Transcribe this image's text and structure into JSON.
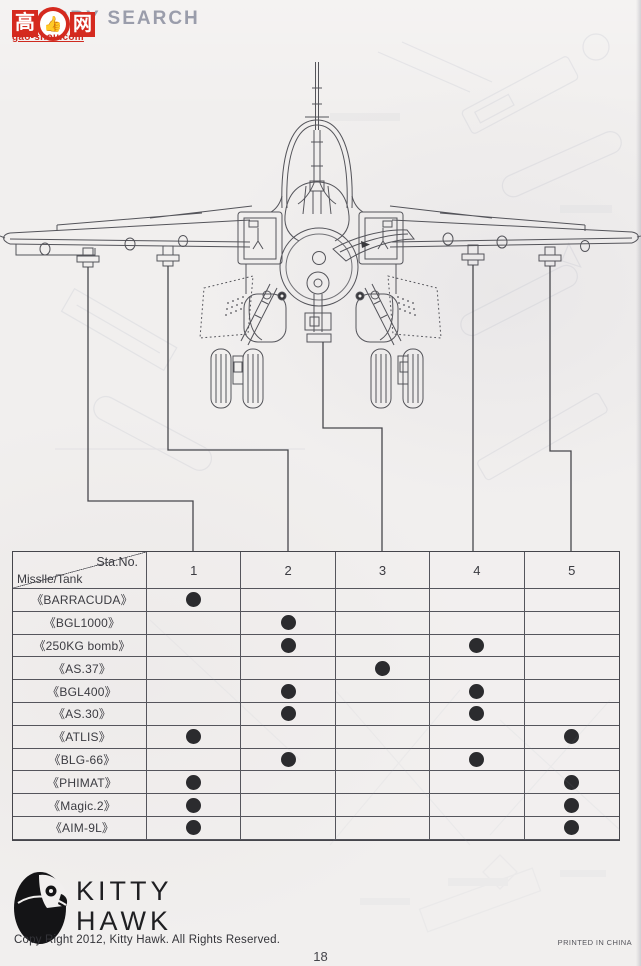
{
  "watermark": {
    "brand": "HOBBY SEARCH",
    "logo_left_char": "高",
    "logo_right_char": "网",
    "thumb_icon": "👍",
    "domain": "gao-shou.com",
    "red": "#d52a1f",
    "gray": "#9a9dab"
  },
  "table": {
    "corner": {
      "top_right": "Sta.No.",
      "bottom_left": "Misslle/Tank"
    },
    "station_headers": [
      "1",
      "2",
      "3",
      "4",
      "5"
    ],
    "dot_color": "#2b2b2e",
    "rows": [
      {
        "label": "《BARRACUDA》",
        "stations": [
          1
        ]
      },
      {
        "label": "《BGL1000》",
        "stations": [
          2
        ]
      },
      {
        "label": "《250KG bomb》",
        "stations": [
          2,
          4
        ]
      },
      {
        "label": "《AS.37》",
        "stations": [
          3
        ]
      },
      {
        "label": "《BGL400》",
        "stations": [
          2,
          4
        ]
      },
      {
        "label": "《AS.30》",
        "stations": [
          2,
          4
        ]
      },
      {
        "label": "《ATLIS》",
        "stations": [
          1,
          5
        ]
      },
      {
        "label": "《BLG-66》",
        "stations": [
          2,
          4
        ]
      },
      {
        "label": "《PHIMAT》",
        "stations": [
          1,
          5
        ]
      },
      {
        "label": "《Magic.2》",
        "stations": [
          1,
          5
        ]
      },
      {
        "label": "《AIM-9L》",
        "stations": [
          1,
          5
        ]
      }
    ]
  },
  "footer": {
    "brand_line1": "KITTY",
    "brand_line2": "HAWK",
    "copyright": "Copy Right 2012, Kitty Hawk. All Rights Reserved.",
    "printed_in": "PRINTED IN CHINA",
    "page_number": "18"
  }
}
